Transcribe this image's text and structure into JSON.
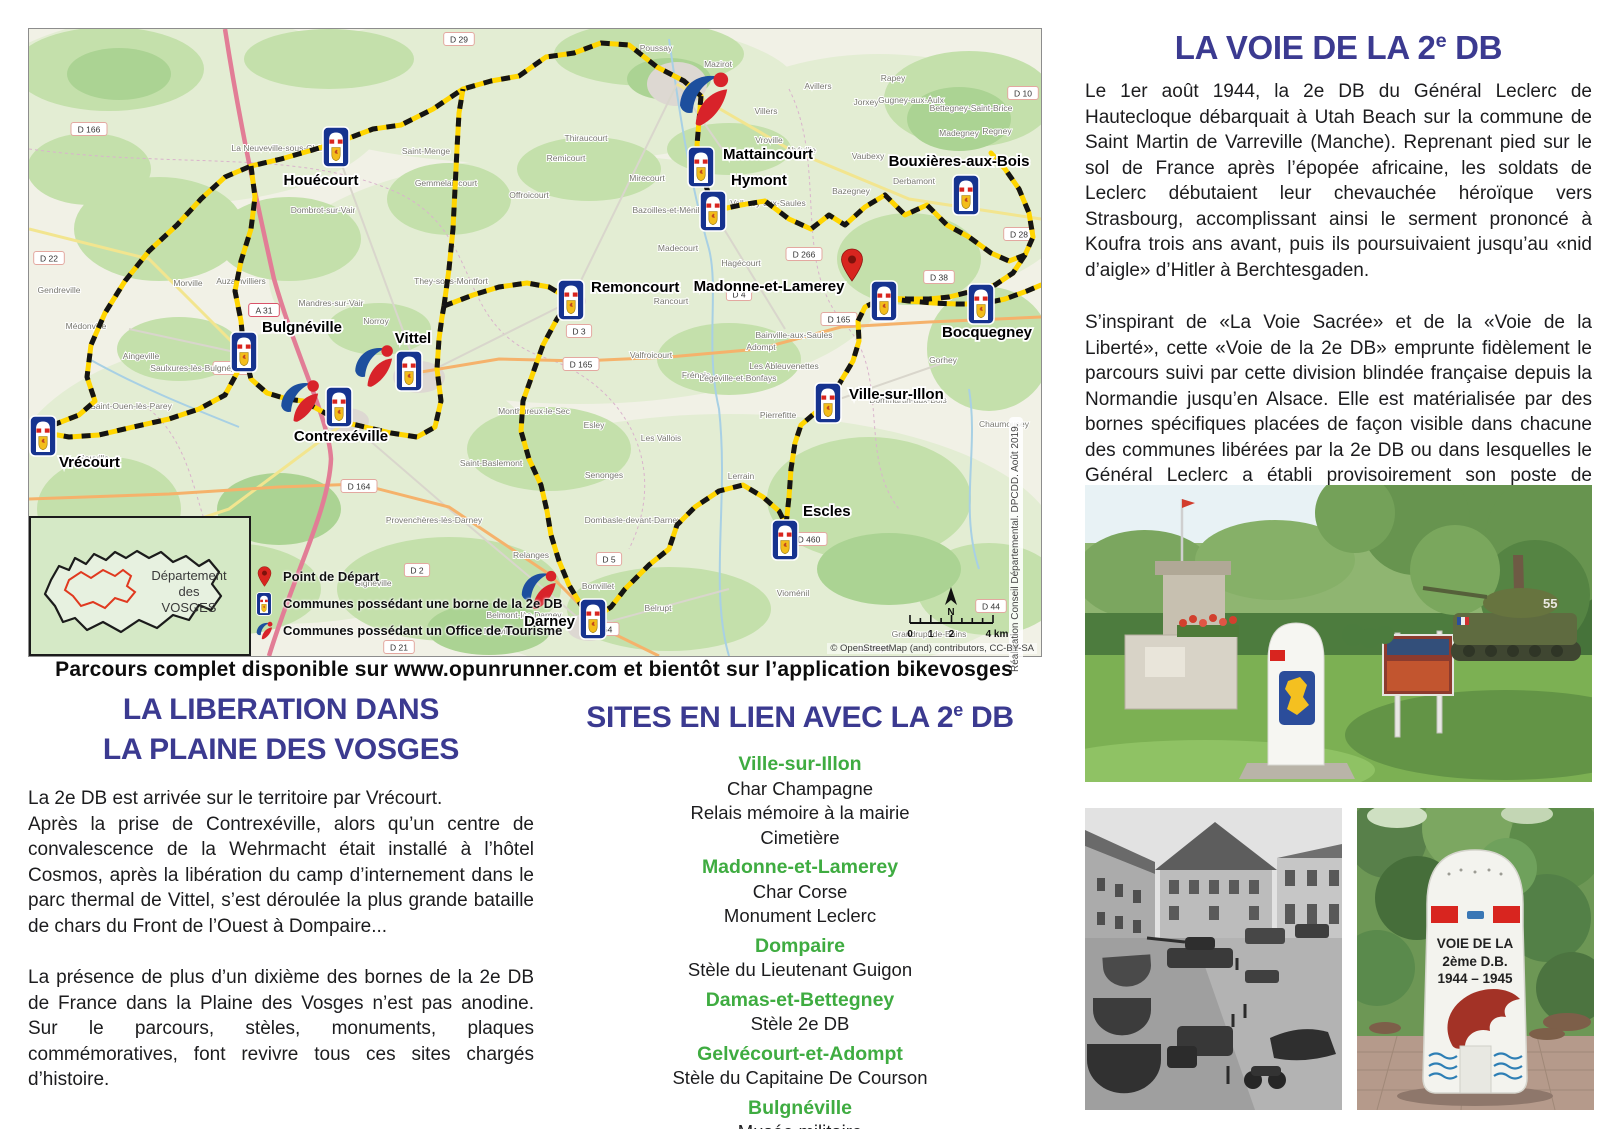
{
  "banner": "Parcours complet disponible sur www.opunrunner.com et bientôt sur l’application bikevosges",
  "liberation": {
    "title_lines": [
      "LA LIBERATION DANS",
      "LA PLAINE DES VOSGES"
    ],
    "para1": "La 2e DB est arrivée sur le territoire par Vrécourt.",
    "para2": "Après la prise de Contrexéville, alors qu’un centre de convalescence de la Wehrmacht était installé à l’hôtel Cosmos, après la libération du camp d’internement dans le parc thermal de Vittel, s’est déroulée la plus grande bataille de chars du Front de l’Ouest à Dompaire...",
    "para3": "La présence de plus d’un dixième des bornes de la 2e DB de France dans la Plaine des Vosges n’est pas anodine. Sur le parcours, stèles, monuments, plaques commémoratives, font revivre tous ces sites chargés d’histoire."
  },
  "sites": {
    "title_parts": [
      "SITES EN LIEN AVEC LA 2",
      "e",
      " DB"
    ],
    "entries": [
      {
        "town": "Ville-sur-Illon",
        "items": [
          "Char Champagne",
          "Relais mémoire à la mairie",
          "Cimetière"
        ]
      },
      {
        "town": "Madonne-et-Lamerey",
        "items": [
          "Char Corse",
          "Monument Leclerc"
        ]
      },
      {
        "town": "Dompaire",
        "items": [
          "Stèle du Lieutenant Guigon"
        ]
      },
      {
        "town": "Damas-et-Bettegney",
        "items": [
          "Stèle 2e DB"
        ]
      },
      {
        "town": "Gelvécourt-et-Adompt",
        "items": [
          "Stèle du Capitaine De Courson"
        ]
      },
      {
        "town": "Bulgnéville",
        "items": [
          "Musée militaire"
        ]
      }
    ]
  },
  "voie": {
    "title_parts": [
      "LA VOIE DE LA 2",
      "e",
      " DB"
    ],
    "para1": "Le 1er août 1944, la 2e DB du Général Leclerc de Hautecloque débarquait à Utah Beach sur la commune de Saint Martin de Varreville (Manche). Reprenant pied sur le sol de France après l’épopée africaine, les soldats de Leclerc débutaient leur chevauchée héroïque vers Strasbourg, accomplissant ainsi le serment prononcé à Koufra trois ans avant, puis ils poursuivaient jusqu’au «nid d’aigle» d’Hitler à Berchtesgaden.",
    "para2": "S’inspirant de «La Voie Sacrée» et de la «Voie de la Liberté», cette «Voie de la 2e DB» emprunte fidèlement le parcours suivi par cette division blindée française depuis la Normandie jusqu’en Alsace. Elle est matérialisée par des bornes spécifiques placées de façon visible dans chacune des communes libérées par la 2e DB ou dans lesquelles le Général Leclerc a établi provisoirement son poste de commandement.",
    "attribution": "Général d’armée Bruno Cuche"
  },
  "photos": {
    "borne_text": [
      "VOIE DE LA",
      "2ème D.B.",
      "1944 – 1945"
    ],
    "tank_number": "55"
  },
  "map": {
    "legend": [
      {
        "icon": "pin",
        "label": "Point de Départ"
      },
      {
        "icon": "borne",
        "label": "Communes possédant une borne de la 2e DB"
      },
      {
        "icon": "ot",
        "label": "Communes possédant un Office de Tourisme"
      }
    ],
    "inset": {
      "lines": [
        "Département",
        "des",
        "VOSGES"
      ]
    },
    "scale": {
      "ticks": [
        "0",
        "1",
        "2",
        "4 km"
      ]
    },
    "north": "N",
    "credit_vertical": "Réalisation Conseil Départemental. DPCDD. Août 2019.",
    "credit_bottom": "© OpenStreetMap (and) contributors, CC-BY-SA",
    "start_pin": {
      "town": "Madonne-et-Lamerey",
      "x": 823,
      "y": 252
    },
    "towns": [
      {
        "name": "Houécourt",
        "ix": 307,
        "iy": 118,
        "lx": 292,
        "ly": 156,
        "anchor": "middle"
      },
      {
        "name": "Mattaincourt",
        "ix": 672,
        "iy": 138,
        "lx": 694,
        "ly": 130,
        "anchor": "start"
      },
      {
        "name": "Hymont",
        "ix": 684,
        "iy": 182,
        "lx": 702,
        "ly": 156,
        "anchor": "start"
      },
      {
        "name": "Bouxières-aux-Bois",
        "ix": 937,
        "iy": 166,
        "lx": 930,
        "ly": 137,
        "anchor": "middle"
      },
      {
        "name": "Remoncourt",
        "ix": 542,
        "iy": 271,
        "lx": 562,
        "ly": 263,
        "anchor": "start"
      },
      {
        "name": "Madonne-et-Lamerey",
        "ix": 855,
        "iy": 272,
        "lx": 740,
        "ly": 262,
        "anchor": "middle"
      },
      {
        "name": "Bocquegney",
        "ix": 952,
        "iy": 275,
        "lx": 958,
        "ly": 308,
        "anchor": "middle"
      },
      {
        "name": "Ville-sur-Illon",
        "ix": 799,
        "iy": 374,
        "lx": 820,
        "ly": 370,
        "anchor": "start"
      },
      {
        "name": "Escles",
        "ix": 756,
        "iy": 511,
        "lx": 774,
        "ly": 487,
        "anchor": "start"
      },
      {
        "name": "Darney",
        "ix": 564,
        "iy": 590,
        "lx": 546,
        "ly": 597,
        "anchor": "end"
      },
      {
        "name": "Bulgnéville",
        "ix": 215,
        "iy": 323,
        "lx": 233,
        "ly": 303,
        "anchor": "start"
      },
      {
        "name": "Contrexéville",
        "ix": 310,
        "iy": 378,
        "lx": 312,
        "ly": 412,
        "anchor": "middle"
      },
      {
        "name": "Vittel",
        "ix": 380,
        "iy": 342,
        "lx": 384,
        "ly": 314,
        "anchor": "middle"
      },
      {
        "name": "Vrécourt",
        "ix": 14,
        "iy": 407,
        "lx": 30,
        "ly": 438,
        "anchor": "start"
      }
    ],
    "tourism_offices": [
      {
        "town": "Mirecourt",
        "x": 675,
        "y": 70,
        "s": 64
      },
      {
        "town": "Vittel",
        "x": 345,
        "y": 337,
        "s": 50
      },
      {
        "town": "Contrexéville",
        "x": 271,
        "y": 372,
        "s": 50
      },
      {
        "town": "Darney",
        "x": 510,
        "y": 561,
        "s": 46
      }
    ],
    "road_labels": [
      {
        "text": "D 29",
        "x": 430,
        "y": 10
      },
      {
        "text": "D 10",
        "x": 994,
        "y": 64
      },
      {
        "text": "D 166",
        "x": 60,
        "y": 100
      },
      {
        "text": "D 22",
        "x": 20,
        "y": 229
      },
      {
        "text": "A 31",
        "x": 235,
        "y": 281,
        "type": "motorway"
      },
      {
        "text": "D 164",
        "x": 330,
        "y": 457
      },
      {
        "text": "D 164",
        "x": 572,
        "y": 600
      },
      {
        "text": "D 5",
        "x": 580,
        "y": 530
      },
      {
        "text": "D 3",
        "x": 550,
        "y": 302
      },
      {
        "text": "D 165",
        "x": 552,
        "y": 335
      },
      {
        "text": "D 165",
        "x": 810,
        "y": 290
      },
      {
        "text": "D 4",
        "x": 710,
        "y": 265
      },
      {
        "text": "D 266",
        "x": 775,
        "y": 225
      },
      {
        "text": "D 38",
        "x": 910,
        "y": 248
      },
      {
        "text": "D 460",
        "x": 780,
        "y": 510
      },
      {
        "text": "D 44",
        "x": 962,
        "y": 577
      },
      {
        "text": "D 2",
        "x": 388,
        "y": 541
      },
      {
        "text": "D 21",
        "x": 370,
        "y": 618
      },
      {
        "text": "D 229",
        "x": 202,
        "y": 339
      },
      {
        "text": "D 28",
        "x": 990,
        "y": 205
      }
    ],
    "villages": [
      {
        "name": "Poussay",
        "x": 627,
        "y": 22
      },
      {
        "name": "Mazirot",
        "x": 689,
        "y": 38
      },
      {
        "name": "Thiraucourt",
        "x": 557,
        "y": 112
      },
      {
        "name": "Remicourt",
        "x": 537,
        "y": 132
      },
      {
        "name": "Mirecourt",
        "x": 618,
        "y": 152
      },
      {
        "name": "Villers",
        "x": 737,
        "y": 85
      },
      {
        "name": "Avillers",
        "x": 789,
        "y": 60
      },
      {
        "name": "Jorxey",
        "x": 837,
        "y": 76
      },
      {
        "name": "Rapey",
        "x": 864,
        "y": 52
      },
      {
        "name": "Gugney-aux-Aulx",
        "x": 882,
        "y": 74
      },
      {
        "name": "Bettegney-Saint-Brice",
        "x": 942,
        "y": 82
      },
      {
        "name": "Madegney",
        "x": 930,
        "y": 107
      },
      {
        "name": "Regney",
        "x": 968,
        "y": 105
      },
      {
        "name": "Vaubexy",
        "x": 839,
        "y": 130
      },
      {
        "name": "Derbamont",
        "x": 885,
        "y": 155
      },
      {
        "name": "Vroville",
        "x": 740,
        "y": 114
      },
      {
        "name": "Ahéville",
        "x": 772,
        "y": 124
      },
      {
        "name": "Bazegney",
        "x": 822,
        "y": 165
      },
      {
        "name": "Bazoilles-et-Ménil",
        "x": 637,
        "y": 184
      },
      {
        "name": "Madecourt",
        "x": 649,
        "y": 222
      },
      {
        "name": "Valleroy-aux-Saules",
        "x": 739,
        "y": 177
      },
      {
        "name": "Hagécourt",
        "x": 712,
        "y": 237
      },
      {
        "name": "Rancourt",
        "x": 642,
        "y": 275
      },
      {
        "name": "Bainville-aux-Saules",
        "x": 765,
        "y": 309
      },
      {
        "name": "Adompt",
        "x": 732,
        "y": 321
      },
      {
        "name": "Valfroicourt",
        "x": 622,
        "y": 329
      },
      {
        "name": "Frénois",
        "x": 667,
        "y": 349
      },
      {
        "name": "Légéville-et-Bonfays",
        "x": 709,
        "y": 352
      },
      {
        "name": "Les Ableuvenettes",
        "x": 755,
        "y": 340
      },
      {
        "name": "Pierrefitte",
        "x": 749,
        "y": 389
      },
      {
        "name": "Gorhey",
        "x": 914,
        "y": 334
      },
      {
        "name": "Dommartin-aux-Bois",
        "x": 879,
        "y": 374
      },
      {
        "name": "Chaumousey",
        "x": 975,
        "y": 398
      },
      {
        "name": "Esley",
        "x": 565,
        "y": 399
      },
      {
        "name": "Les Vallois",
        "x": 632,
        "y": 412
      },
      {
        "name": "Monthureux-le-Sec",
        "x": 505,
        "y": 385
      },
      {
        "name": "Saint-Baslemont",
        "x": 462,
        "y": 437
      },
      {
        "name": "Senonges",
        "x": 575,
        "y": 449
      },
      {
        "name": "Dombasle-devant-Darney",
        "x": 604,
        "y": 494
      },
      {
        "name": "Lerrain",
        "x": 712,
        "y": 450
      },
      {
        "name": "Vioménil",
        "x": 764,
        "y": 567
      },
      {
        "name": "Belrupt",
        "x": 629,
        "y": 582
      },
      {
        "name": "Bonvillet",
        "x": 569,
        "y": 560
      },
      {
        "name": "Relanges",
        "x": 502,
        "y": 529
      },
      {
        "name": "Nonville",
        "x": 470,
        "y": 605
      },
      {
        "name": "Belmont-lès-Darney",
        "x": 495,
        "y": 589
      },
      {
        "name": "Gendreville",
        "x": 30,
        "y": 264
      },
      {
        "name": "Médonville",
        "x": 57,
        "y": 300
      },
      {
        "name": "Aingeville",
        "x": 112,
        "y": 330
      },
      {
        "name": "Saint-Ouen-lès-Parey",
        "x": 102,
        "y": 380
      },
      {
        "name": "Sauville",
        "x": 65,
        "y": 432
      },
      {
        "name": "Saulxures-lès-Bulgnéville",
        "x": 169,
        "y": 342
      },
      {
        "name": "Auzainvilliers",
        "x": 212,
        "y": 255
      },
      {
        "name": "Mandres-sur-Vair",
        "x": 302,
        "y": 277
      },
      {
        "name": "Norroy",
        "x": 347,
        "y": 295
      },
      {
        "name": "They-sous-Montfort",
        "x": 422,
        "y": 255
      },
      {
        "name": "Morville",
        "x": 159,
        "y": 257
      },
      {
        "name": "La Neuveville-sous-Châtenois",
        "x": 259,
        "y": 122
      },
      {
        "name": "Saint-Menge",
        "x": 397,
        "y": 125
      },
      {
        "name": "Gemmelaincourt",
        "x": 417,
        "y": 157
      },
      {
        "name": "Dombrot-sur-Vair",
        "x": 294,
        "y": 184
      },
      {
        "name": "Offroicourt",
        "x": 500,
        "y": 169
      },
      {
        "name": "Gignéville",
        "x": 344,
        "y": 557
      },
      {
        "name": "Provenchères-lès-Darney",
        "x": 405,
        "y": 494
      },
      {
        "name": "Grandrupt-de-Bains",
        "x": 900,
        "y": 608
      },
      {
        "name": "La Haye",
        "x": 845,
        "y": 622
      }
    ]
  }
}
